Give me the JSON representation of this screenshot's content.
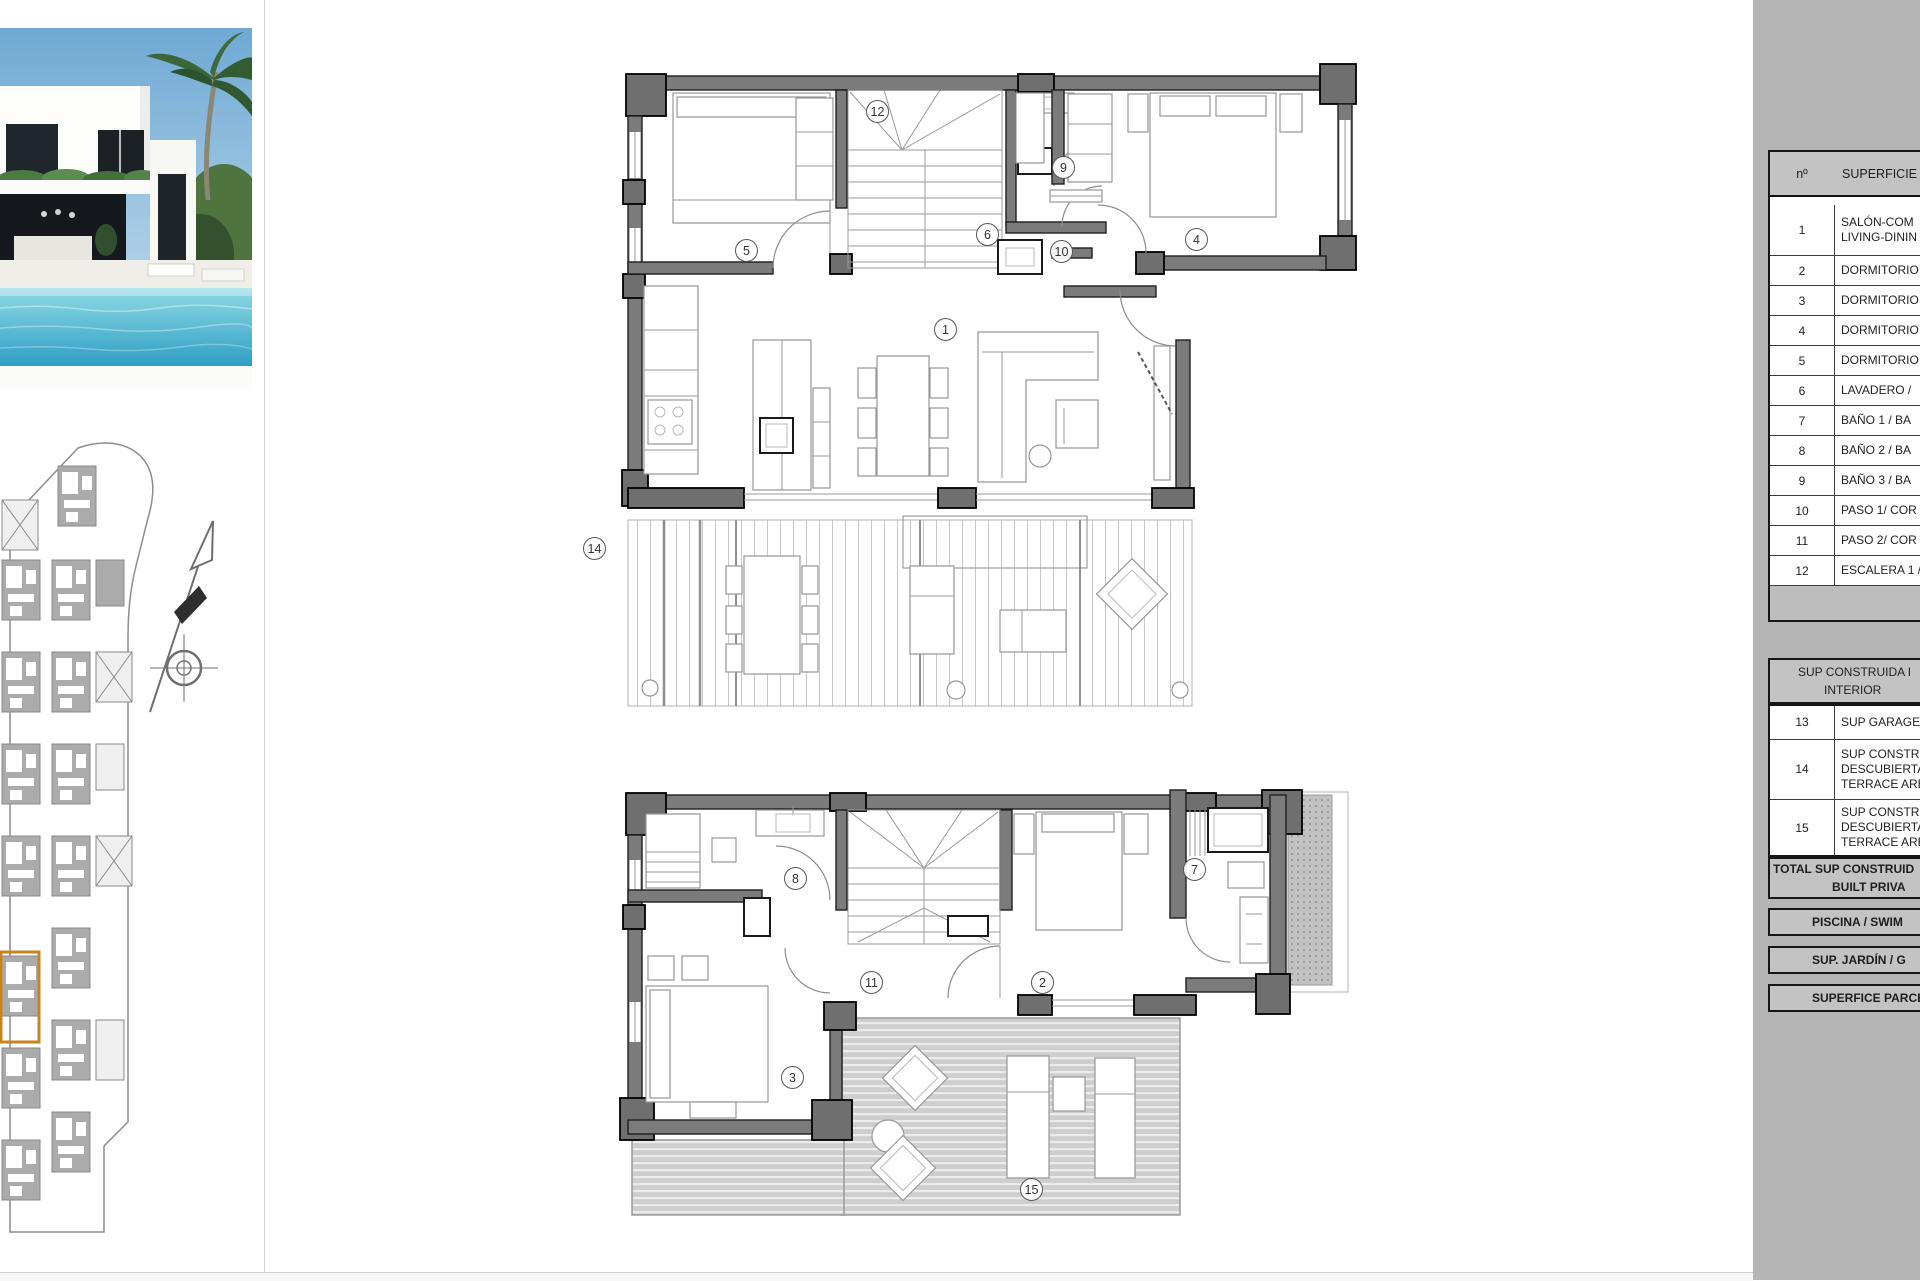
{
  "photo": {
    "name": "villa-exterior-photo"
  },
  "site_plan": {
    "name": "urbanization-site-plan",
    "highlight_color": "#c8841e"
  },
  "markers": {
    "upper": [
      "12",
      "9",
      "5",
      "6",
      "10",
      "4",
      "1",
      "14"
    ],
    "lower": [
      "8",
      "7",
      "11",
      "2",
      "3",
      "15"
    ]
  },
  "table": {
    "header": {
      "no": "nº",
      "area": "SUPERFICIE Ú"
    },
    "rows": [
      {
        "no": "1",
        "lines": [
          "SALÓN-COM",
          "LIVING-DININ"
        ]
      },
      {
        "no": "2",
        "lines": [
          "DORMITORIO"
        ]
      },
      {
        "no": "3",
        "lines": [
          "DORMITORIO"
        ]
      },
      {
        "no": "4",
        "lines": [
          "DORMITORIO"
        ]
      },
      {
        "no": "5",
        "lines": [
          "DORMITORIO"
        ]
      },
      {
        "no": "6",
        "lines": [
          "LAVADERO /"
        ]
      },
      {
        "no": "7",
        "lines": [
          "BAÑO 1 / BA"
        ]
      },
      {
        "no": "8",
        "lines": [
          "BAÑO 2 / BA"
        ]
      },
      {
        "no": "9",
        "lines": [
          "BAÑO 3 / BA"
        ]
      },
      {
        "no": "10",
        "lines": [
          "PASO 1/ COR"
        ]
      },
      {
        "no": "11",
        "lines": [
          "PASO 2/ COR"
        ]
      },
      {
        "no": "12",
        "lines": [
          "ESCALERA 1 /"
        ]
      }
    ],
    "section_header_lines": [
      "SUP CONSTRUIDA I",
      "INTERIOR"
    ],
    "outdoor_rows": [
      {
        "no": "13",
        "lines": [
          "SUP GARAGE"
        ]
      },
      {
        "no": "14",
        "lines": [
          "SUP CONSTRU",
          "DESCUBIERTA",
          "TERRACE ARE"
        ]
      },
      {
        "no": "15",
        "lines": [
          "SUP CONSTRU",
          "DESCUBIERTA",
          "TERRACE ARE"
        ]
      }
    ],
    "total_lines": [
      "TOTAL SUP CONSTRUID",
      "BUILT PRIVA"
    ],
    "bands": [
      "PISCINA / SWIM",
      "SUP. JARDÍN / G",
      "SUPERFICE PARCE"
    ]
  }
}
